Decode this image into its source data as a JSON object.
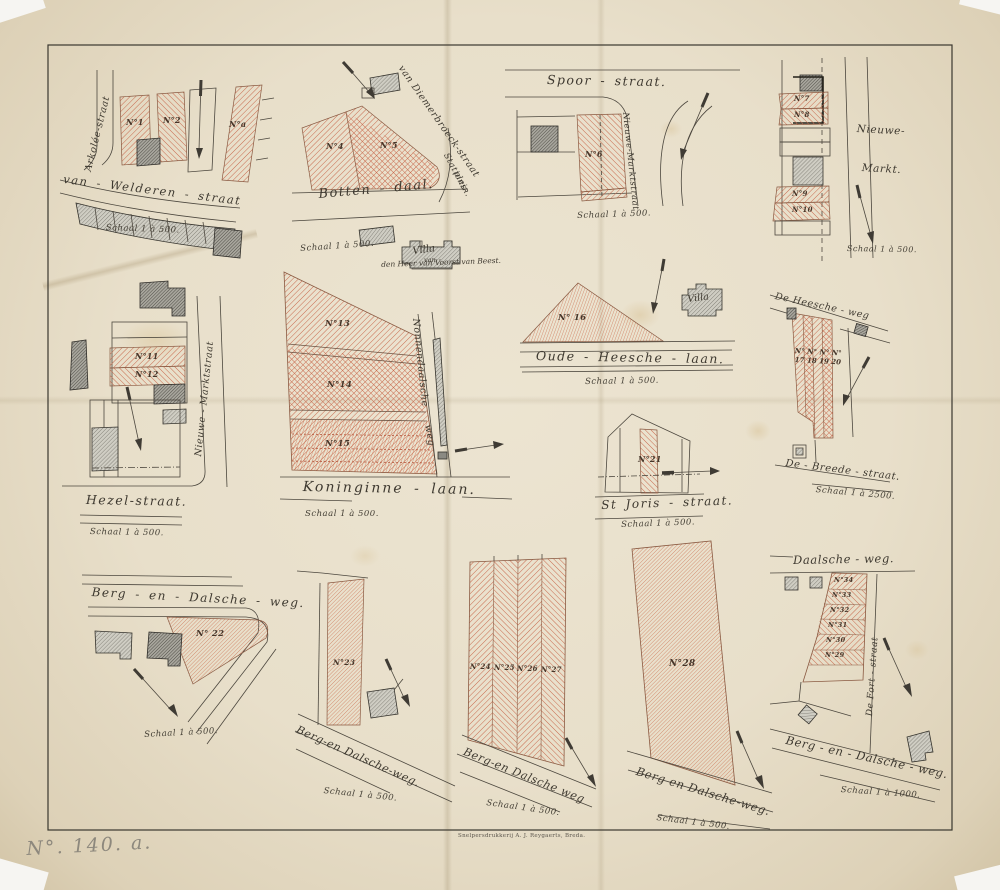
{
  "document": {
    "archive_note": "N°. 140. a.",
    "imprint": "Snelpersdrukkerij A. J. Reygaerts, Breda."
  },
  "plans": {
    "van_welderen": {
      "street_vertical": "Arkolée-straat",
      "street_main": "van - Welderen - straat",
      "plot1": "N°1",
      "plot2": "N°2",
      "plota": "N°a",
      "scale": "Schaal 1 à 500."
    },
    "bottendaal": {
      "street_main": "Botten - daal.",
      "street_diagonal": "van Diemerbroeck-straat",
      "plein_line1": "Stations-",
      "plein_line2": "plein.",
      "plot4": "N°4",
      "plot5": "N°5",
      "scale": "Schaal 1 à 500.",
      "villa": "Villa",
      "villa_van": "van",
      "villa_owner": "den Heer van Voorst van Beest."
    },
    "spoorstraat": {
      "street_main": "Spoor - straat.",
      "street_cross": "Nieuwe-Marktstraat",
      "plot6": "N°6",
      "scale": "Schaal 1 à 500."
    },
    "nieuwe_markt": {
      "name_line1": "Nieuwe-",
      "name_line2": "Markt.",
      "plot7": "N°7",
      "plot8": "N°8",
      "plot9": "N°9",
      "plot10": "N°10",
      "scale": "Schaal 1 à 500."
    },
    "hezelstraat": {
      "street_main": "Hezel-straat.",
      "street_cross": "Nieuwe - Marktstraat",
      "plot11": "N°11",
      "plot12": "N°12",
      "scale": "Schaal 1 à 500."
    },
    "koninginnelaan": {
      "street_main": "Koninginne - laan.",
      "street_cross_1": "Nonnendaalsche",
      "street_cross_2": "weg",
      "plot13": "N°13",
      "plot14": "N°14",
      "plot15": "N°15",
      "scale": "Schaal 1 à 500."
    },
    "oude_heesche_laan": {
      "street_main": "Oude - Heesche - laan.",
      "plot16": "N° 16",
      "villa": "Villa",
      "scale": "Schaal 1 à 500."
    },
    "heesche_weg": {
      "street_top": "De Heesche - weg",
      "plots_line1": "N° N° N° N°",
      "plots_line2": "17 18 19 20",
      "street_bottom": "De - Breede - straat.",
      "scale": "Schaal 1 à 2500."
    },
    "st_joris": {
      "street_main": "St Joris - straat.",
      "plot21": "N°21",
      "scale": "Schaal 1 à 500."
    },
    "berg_en_dal_22": {
      "street_main": "Berg - en - Dalsche - weg.",
      "plot22": "N° 22",
      "scale": "Schaal 1 à 500."
    },
    "berg_en_dal_23": {
      "street_main": "Berg-en Dalsche-weg.",
      "plot23": "N°23",
      "scale": "Schaal 1 à 500."
    },
    "berg_en_dal_24_27": {
      "street_main": "Berg-en Dalsche weg",
      "plot24": "N°24",
      "plot25": "N°25",
      "plot26": "N°26",
      "plot27": "N°27",
      "scale": "Schaal 1 à 500."
    },
    "berg_en_dal_28": {
      "street_main": "Berg en Dalsche-weg.",
      "plot28": "N°28",
      "scale": "Schaal 1 à 500."
    },
    "daalsche_weg": {
      "street_top": "Daalsche - weg.",
      "street_cross": "De Fort - straat",
      "street_bottom": "Berg - en - Dalsche - weg.",
      "plot29": "N°29",
      "plot30": "N°30",
      "plot31": "N°31",
      "plot32": "N°32",
      "plot33": "N°33",
      "plot34": "N°34",
      "scale": "Schaal 1 à 1000."
    }
  }
}
